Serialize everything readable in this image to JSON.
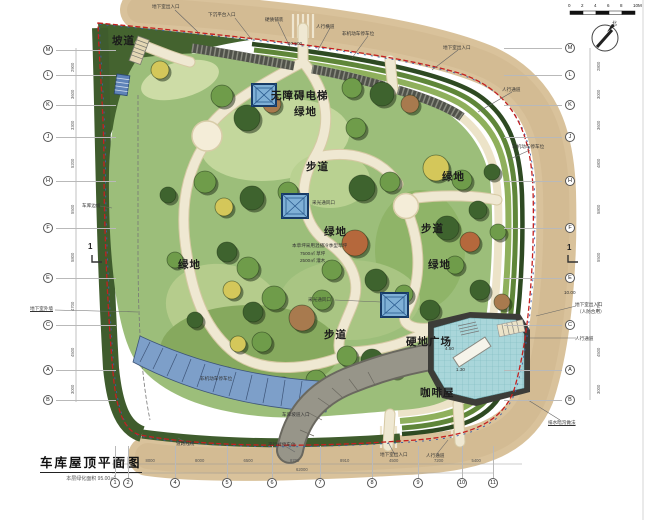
{
  "title_block": {
    "title": "车库屋顶平面图",
    "subtitle": "本层绿化面积 95.00㎡"
  },
  "scale_bar": {
    "labels": [
      "0",
      "2",
      "4",
      "6",
      "8",
      "10M"
    ]
  },
  "north": {
    "label": "北"
  },
  "section_markers": [
    {
      "label": "1",
      "x": 88,
      "y": 242
    },
    {
      "label": "1",
      "x": 567,
      "y": 243
    }
  ],
  "grid": {
    "left": [
      {
        "label": "M",
        "y": 50
      },
      {
        "label": "L",
        "y": 75
      },
      {
        "label": "K",
        "y": 105
      },
      {
        "label": "J",
        "y": 137
      },
      {
        "label": "H",
        "y": 181
      },
      {
        "label": "F",
        "y": 228
      },
      {
        "label": "E",
        "y": 278
      },
      {
        "label": "C",
        "y": 325
      },
      {
        "label": "A",
        "y": 370
      },
      {
        "label": "B",
        "y": 400
      }
    ],
    "right": [
      {
        "label": "M",
        "y": 48
      },
      {
        "label": "L",
        "y": 75
      },
      {
        "label": "K",
        "y": 105
      },
      {
        "label": "J",
        "y": 137
      },
      {
        "label": "H",
        "y": 181
      },
      {
        "label": "F",
        "y": 228
      },
      {
        "label": "E",
        "y": 278
      },
      {
        "label": "C",
        "y": 325
      },
      {
        "label": "A",
        "y": 370
      },
      {
        "label": "B",
        "y": 400
      }
    ],
    "bottom": [
      {
        "label": "1",
        "x": 115
      },
      {
        "label": "2",
        "x": 128
      },
      {
        "label": "4",
        "x": 175
      },
      {
        "label": "5",
        "x": 227
      },
      {
        "label": "6",
        "x": 272
      },
      {
        "label": "7",
        "x": 320
      },
      {
        "label": "8",
        "x": 372
      },
      {
        "label": "9",
        "x": 418
      },
      {
        "label": "10",
        "x": 462
      },
      {
        "label": "11",
        "x": 493
      }
    ]
  },
  "dimensions": {
    "bottom": [
      "4000",
      "8000",
      "8000",
      "6500",
      "8700",
      "8910",
      "4500",
      "7200",
      "5400"
    ],
    "bottom_total": "62000",
    "left": [
      "2900",
      "3600",
      "3300",
      "5200",
      "5500",
      "5800",
      "4700",
      "4500",
      "3000"
    ],
    "right": [
      "2800",
      "3000",
      "3600",
      "4800",
      "5800",
      "5500",
      "4700",
      "4500",
      "3000"
    ]
  },
  "plan": {
    "labels": [
      {
        "t": "坡道",
        "x": 112,
        "y": 33
      },
      {
        "t": "无障碍电梯",
        "x": 271,
        "y": 88
      },
      {
        "t": "绿地",
        "x": 294,
        "y": 104
      },
      {
        "t": "步道",
        "x": 306,
        "y": 159
      },
      {
        "t": "绿地",
        "x": 442,
        "y": 169
      },
      {
        "t": "绿地",
        "x": 324,
        "y": 224
      },
      {
        "t": "步道",
        "x": 421,
        "y": 221
      },
      {
        "t": "绿地",
        "x": 178,
        "y": 257
      },
      {
        "t": "绿地",
        "x": 428,
        "y": 257
      },
      {
        "t": "步道",
        "x": 324,
        "y": 327
      },
      {
        "t": "硬地广场",
        "x": 406,
        "y": 334
      },
      {
        "t": "咖啡屋",
        "x": 420,
        "y": 385
      }
    ],
    "annotations": [
      {
        "t": "地下室出入口",
        "x": 152,
        "y": 4
      },
      {
        "t": "下沉平台入口",
        "x": 208,
        "y": 12
      },
      {
        "t": "硬质铺装",
        "x": 265,
        "y": 17
      },
      {
        "t": "人行横道",
        "x": 316,
        "y": 24
      },
      {
        "t": "非机动车停车位",
        "x": 342,
        "y": 31
      },
      {
        "t": "地下室出入口",
        "x": 443,
        "y": 45
      },
      {
        "t": "人行通道",
        "x": 502,
        "y": 87
      },
      {
        "t": "非机动车停车位",
        "x": 512,
        "y": 144
      },
      {
        "t": "地下室出入口",
        "x": 575,
        "y": 302
      },
      {
        "t": "（人防合用）",
        "x": 577,
        "y": 309
      },
      {
        "t": "人行通道",
        "x": 575,
        "y": 336
      },
      {
        "t": "排水暗沟做法",
        "x": 548,
        "y": 420,
        "u": true
      },
      {
        "t": "道路红线",
        "x": 176,
        "y": 441
      },
      {
        "t": "平行式停车位",
        "x": 268,
        "y": 442
      },
      {
        "t": "地下室出入口",
        "x": 380,
        "y": 452
      },
      {
        "t": "人行通道",
        "x": 426,
        "y": 453
      },
      {
        "t": "车库边线",
        "x": 82,
        "y": 203
      },
      {
        "t": "地下室外墙",
        "x": 30,
        "y": 306,
        "u": true
      },
      {
        "t": "采光通风口",
        "x": 312,
        "y": 200
      },
      {
        "t": "采光通风口",
        "x": 308,
        "y": 297
      },
      {
        "t": "本草坪采用混播冷季型草坪",
        "x": 292,
        "y": 243
      },
      {
        "t": "7500㎡ 草坪",
        "x": 300,
        "y": 251
      },
      {
        "t": "2500㎡ 灌木",
        "x": 300,
        "y": 258
      },
      {
        "t": "车库坡道入口",
        "x": 282,
        "y": 412
      },
      {
        "t": "非机动车停车位",
        "x": 200,
        "y": 376
      },
      {
        "t": "10.500",
        "x": 288,
        "y": 41
      },
      {
        "t": "10.00",
        "x": 564,
        "y": 290
      },
      {
        "t": "4.50",
        "x": 445,
        "y": 346
      },
      {
        "t": "1.30",
        "x": 456,
        "y": 367
      }
    ],
    "trees": [
      {
        "x": 160,
        "y": 70,
        "r": 9,
        "c": "y"
      },
      {
        "x": 222,
        "y": 96,
        "r": 11,
        "c": "m"
      },
      {
        "x": 247,
        "y": 118,
        "r": 13,
        "c": "d"
      },
      {
        "x": 272,
        "y": 104,
        "r": 9,
        "c": "b"
      },
      {
        "x": 205,
        "y": 182,
        "r": 11,
        "c": "m"
      },
      {
        "x": 224,
        "y": 207,
        "r": 9,
        "c": "y"
      },
      {
        "x": 252,
        "y": 198,
        "r": 12,
        "c": "d"
      },
      {
        "x": 288,
        "y": 192,
        "r": 10,
        "c": "m"
      },
      {
        "x": 227,
        "y": 252,
        "r": 10,
        "c": "d"
      },
      {
        "x": 248,
        "y": 268,
        "r": 11,
        "c": "m"
      },
      {
        "x": 232,
        "y": 290,
        "r": 9,
        "c": "y"
      },
      {
        "x": 253,
        "y": 312,
        "r": 10,
        "c": "d"
      },
      {
        "x": 274,
        "y": 298,
        "r": 12,
        "c": "m"
      },
      {
        "x": 302,
        "y": 318,
        "r": 13,
        "c": "b"
      },
      {
        "x": 322,
        "y": 300,
        "r": 10,
        "c": "m"
      },
      {
        "x": 262,
        "y": 342,
        "r": 10,
        "c": "m"
      },
      {
        "x": 238,
        "y": 344,
        "r": 8,
        "c": "y"
      },
      {
        "x": 352,
        "y": 88,
        "r": 10,
        "c": "m"
      },
      {
        "x": 382,
        "y": 94,
        "r": 12,
        "c": "d"
      },
      {
        "x": 410,
        "y": 104,
        "r": 9,
        "c": "b"
      },
      {
        "x": 356,
        "y": 128,
        "r": 10,
        "c": "m"
      },
      {
        "x": 436,
        "y": 168,
        "r": 13,
        "c": "y"
      },
      {
        "x": 462,
        "y": 180,
        "r": 10,
        "c": "m"
      },
      {
        "x": 492,
        "y": 172,
        "r": 8,
        "c": "d"
      },
      {
        "x": 478,
        "y": 210,
        "r": 9,
        "c": "d"
      },
      {
        "x": 362,
        "y": 188,
        "r": 13,
        "c": "d"
      },
      {
        "x": 390,
        "y": 182,
        "r": 10,
        "c": "m"
      },
      {
        "x": 447,
        "y": 228,
        "r": 12,
        "c": "d"
      },
      {
        "x": 470,
        "y": 242,
        "r": 10,
        "c": "r"
      },
      {
        "x": 498,
        "y": 232,
        "r": 8,
        "c": "m"
      },
      {
        "x": 455,
        "y": 265,
        "r": 9,
        "c": "m"
      },
      {
        "x": 480,
        "y": 290,
        "r": 10,
        "c": "d"
      },
      {
        "x": 502,
        "y": 302,
        "r": 8,
        "c": "b"
      },
      {
        "x": 355,
        "y": 243,
        "r": 13,
        "c": "r"
      },
      {
        "x": 332,
        "y": 270,
        "r": 10,
        "c": "m"
      },
      {
        "x": 376,
        "y": 280,
        "r": 11,
        "c": "d"
      },
      {
        "x": 404,
        "y": 294,
        "r": 9,
        "c": "m"
      },
      {
        "x": 430,
        "y": 310,
        "r": 10,
        "c": "d"
      },
      {
        "x": 347,
        "y": 356,
        "r": 10,
        "c": "m"
      },
      {
        "x": 372,
        "y": 360,
        "r": 11,
        "c": "d"
      },
      {
        "x": 395,
        "y": 370,
        "r": 8,
        "c": "y"
      },
      {
        "x": 316,
        "y": 380,
        "r": 10,
        "c": "m"
      },
      {
        "x": 283,
        "y": 386,
        "r": 9,
        "c": "d"
      },
      {
        "x": 252,
        "y": 386,
        "r": 10,
        "c": "m"
      },
      {
        "x": 227,
        "y": 375,
        "r": 8,
        "c": "y"
      },
      {
        "x": 195,
        "y": 320,
        "r": 8,
        "c": "d"
      },
      {
        "x": 175,
        "y": 260,
        "r": 8,
        "c": "m"
      },
      {
        "x": 168,
        "y": 195,
        "r": 8,
        "c": "d"
      }
    ]
  },
  "colors": {
    "boundary_red": "#c42020",
    "boundary_blue": "#3a5fa8",
    "road_tan": "#d9c29b",
    "lawn": "#9cbe7a",
    "lawn_light": "#c3d79c",
    "hedge_dark": "#3f5c2d",
    "path_cream": "#efe8d2",
    "plaza_water": "#a9d6da",
    "parking_blue": "#7d9fc9",
    "ramp_gray": "#918f88",
    "skylight_fill": "#7fb0d6",
    "skylight_border": "#173a66",
    "tree_dark": "#3e632e",
    "tree_mid": "#6f9c4a",
    "tree_yellow": "#d4c75a",
    "tree_brown": "#a87a4e",
    "tree_rust": "#b5683c"
  }
}
